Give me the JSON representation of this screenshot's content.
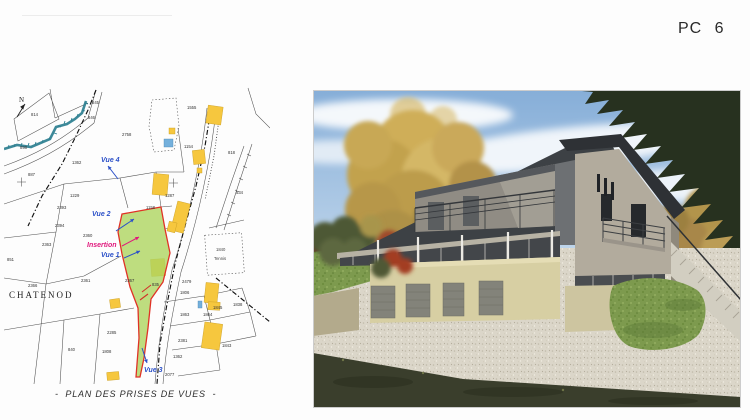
{
  "header": {
    "label": "PC 6"
  },
  "map": {
    "caption": "-  PLAN DES PRISES DE VUES  -",
    "place_label": "CHATENOD",
    "north_label": "N",
    "tennis": {
      "parcel": "1840",
      "label": "Tennis"
    },
    "views": [
      {
        "label": "Vue 4",
        "color": "#2b50c8",
        "x": 97,
        "y": 76,
        "arrow": [
          114,
          93,
          104,
          80
        ]
      },
      {
        "label": "Vue 2",
        "color": "#2b50c8",
        "x": 88,
        "y": 130,
        "arrow": [
          112,
          145,
          130,
          133
        ]
      },
      {
        "label": "Insertion",
        "color": "#e0187c",
        "x": 83,
        "y": 161,
        "arrow": [
          118,
          160,
          135,
          151
        ]
      },
      {
        "label": "Vue 1",
        "color": "#2b50c8",
        "x": 97,
        "y": 171,
        "arrow": [
          120,
          172,
          136,
          165
        ]
      },
      {
        "label": "Vue 3",
        "color": "#2b50c8",
        "x": 140,
        "y": 286,
        "arrow": [
          138,
          262,
          143,
          277
        ]
      }
    ],
    "parcel_numbers": [
      {
        "n": "814",
        "x": 27,
        "y": 30
      },
      {
        "n": "845",
        "x": 88,
        "y": 18
      },
      {
        "n": "846",
        "x": 84,
        "y": 33
      },
      {
        "n": "898",
        "x": 16,
        "y": 63
      },
      {
        "n": "887",
        "x": 24,
        "y": 90
      },
      {
        "n": "2758",
        "x": 118,
        "y": 50
      },
      {
        "n": "1362",
        "x": 68,
        "y": 78
      },
      {
        "n": "1229",
        "x": 66,
        "y": 111
      },
      {
        "n": "2393",
        "x": 53,
        "y": 123
      },
      {
        "n": "2394",
        "x": 51,
        "y": 141
      },
      {
        "n": "2363",
        "x": 38,
        "y": 160
      },
      {
        "n": "851",
        "x": 3,
        "y": 175
      },
      {
        "n": "2366",
        "x": 24,
        "y": 201
      },
      {
        "n": "2361",
        "x": 77,
        "y": 196
      },
      {
        "n": "2360",
        "x": 79,
        "y": 151
      },
      {
        "n": "1158",
        "x": 142,
        "y": 123
      },
      {
        "n": "1555",
        "x": 183,
        "y": 23
      },
      {
        "n": "1154",
        "x": 180,
        "y": 62
      },
      {
        "n": "818",
        "x": 224,
        "y": 68
      },
      {
        "n": "534",
        "x": 232,
        "y": 108
      },
      {
        "n": "1287",
        "x": 161,
        "y": 111
      },
      {
        "n": "835",
        "x": 148,
        "y": 200
      },
      {
        "n": "2479",
        "x": 178,
        "y": 197
      },
      {
        "n": "1806",
        "x": 176,
        "y": 208
      },
      {
        "n": "1845",
        "x": 209,
        "y": 223
      },
      {
        "n": "1838",
        "x": 229,
        "y": 220
      },
      {
        "n": "1863",
        "x": 176,
        "y": 230
      },
      {
        "n": "1864",
        "x": 199,
        "y": 230
      },
      {
        "n": "2381",
        "x": 174,
        "y": 256
      },
      {
        "n": "1362",
        "x": 169,
        "y": 272
      },
      {
        "n": "2077",
        "x": 161,
        "y": 290
      },
      {
        "n": "1843",
        "x": 218,
        "y": 261
      },
      {
        "n": "1808",
        "x": 98,
        "y": 267
      },
      {
        "n": "2285",
        "x": 103,
        "y": 248
      },
      {
        "n": "840",
        "x": 64,
        "y": 265
      },
      {
        "n": "2367",
        "x": 121,
        "y": 196
      }
    ],
    "colors": {
      "site_fill": "#aed45f",
      "site_border": "#e03226",
      "building_yellow": "#f6c73e",
      "building_blue": "#74b0dc",
      "stream": "#2d7f90",
      "view_label": "#2b50c8",
      "insertion_label": "#e0187c"
    }
  },
  "photo": {
    "colors": {
      "sky": "#86aed8",
      "roof": "#3d4145",
      "facade_dark": "#43464a",
      "gable_wall": "#b2ab9d",
      "garage_wall": "#d7cfa3",
      "garage_door": "#83837a",
      "gravel": "#dbd6c9",
      "grass": "#7d9a4e",
      "autumn_foliage": "#cfae58",
      "conifer": "#27311f",
      "dark_verge": "#3a3e2c"
    }
  }
}
